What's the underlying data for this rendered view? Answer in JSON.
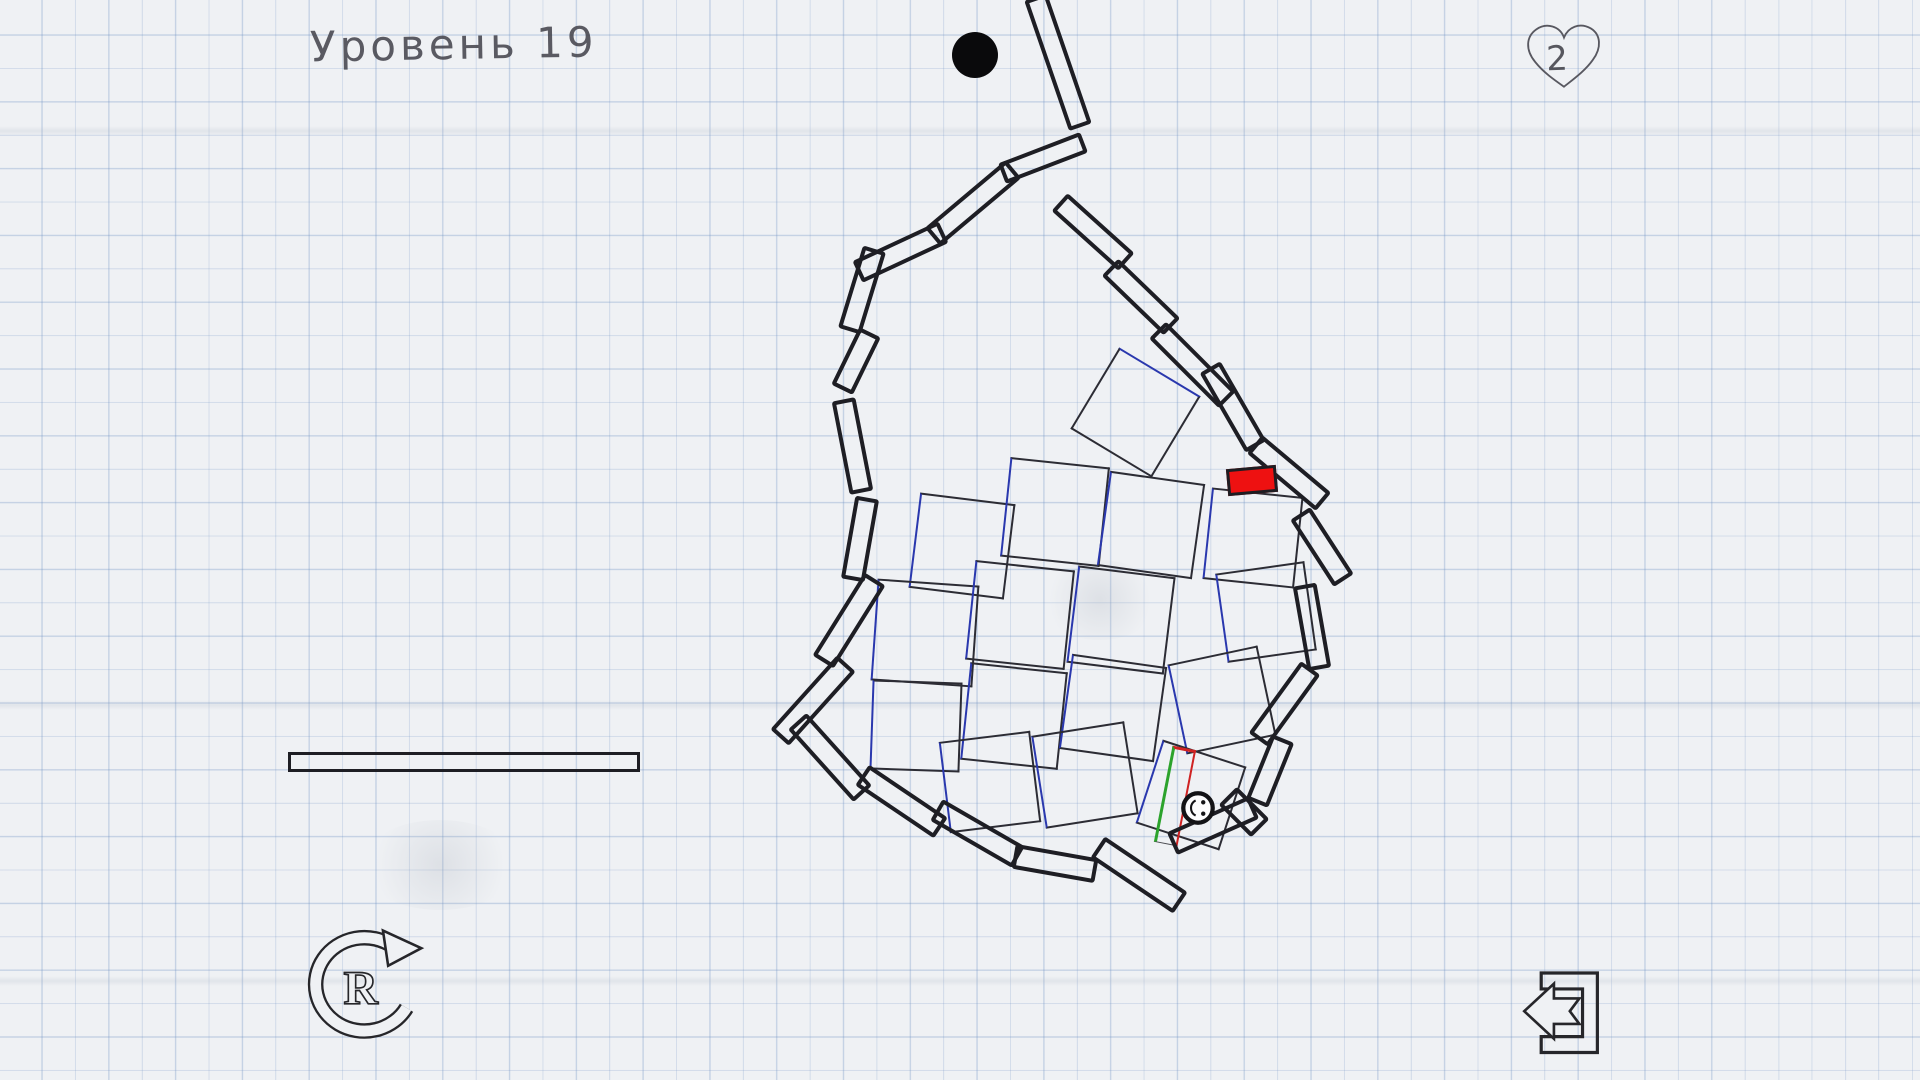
{
  "hud": {
    "level_label": "Уровень 19",
    "lives": "2"
  },
  "buttons": {
    "restart_letter": "R"
  },
  "colors": {
    "paper": "#eff1f4",
    "grid_line": "rgba(112,146,196,0.33)",
    "ink": "#1e1e24",
    "tile_ink": "#2c2c34",
    "blue_edge": "#2a38ae",
    "red_block": "#ee1111",
    "green_edge": "#2ca32c",
    "red_edge": "#cf2222",
    "text_ink": "#46464e"
  },
  "scene": {
    "ball": {
      "x": 975,
      "y": 55,
      "r": 23
    },
    "smiley": {
      "x": 1198,
      "y": 808,
      "r": 19
    },
    "red_block": {
      "x": 1252,
      "y": 480,
      "w": 50,
      "h": 27,
      "rot": -5
    },
    "bar": {
      "x": 464,
      "y": 762,
      "w": 352,
      "h": 20,
      "rot": 0
    },
    "goal_tile": {
      "x": 1175,
      "y": 796,
      "w": 24,
      "h": 98,
      "rot": 11
    },
    "diamond_tile": {
      "x": 1135,
      "y": 412,
      "s": 95,
      "rot": 31
    },
    "planks": [
      {
        "x": 1058,
        "y": 62,
        "len": 138,
        "w": 24,
        "rot": 71
      },
      {
        "x": 1043,
        "y": 158,
        "len": 88,
        "w": 22,
        "rot": -21
      },
      {
        "x": 973,
        "y": 203,
        "len": 106,
        "w": 24,
        "rot": -40
      },
      {
        "x": 900,
        "y": 252,
        "len": 95,
        "w": 24,
        "rot": -25
      },
      {
        "x": 862,
        "y": 290,
        "len": 86,
        "w": 24,
        "rot": -73
      },
      {
        "x": 856,
        "y": 361,
        "len": 64,
        "w": 24,
        "rot": -64
      },
      {
        "x": 852,
        "y": 446,
        "len": 95,
        "w": 24,
        "rot": 79
      },
      {
        "x": 860,
        "y": 539,
        "len": 84,
        "w": 24,
        "rot": 100
      },
      {
        "x": 849,
        "y": 620,
        "len": 98,
        "w": 25,
        "rot": 122
      },
      {
        "x": 813,
        "y": 700,
        "len": 100,
        "w": 25,
        "rot": 132
      },
      {
        "x": 830,
        "y": 757,
        "len": 98,
        "w": 25,
        "rot": 48
      },
      {
        "x": 901,
        "y": 801,
        "len": 95,
        "w": 25,
        "rot": 34
      },
      {
        "x": 977,
        "y": 833,
        "len": 95,
        "w": 25,
        "rot": 30
      },
      {
        "x": 1055,
        "y": 863,
        "len": 84,
        "w": 25,
        "rot": 10
      },
      {
        "x": 1139,
        "y": 875,
        "len": 100,
        "w": 26,
        "rot": 34
      },
      {
        "x": 1213,
        "y": 825,
        "len": 90,
        "w": 25,
        "rot": -24
      },
      {
        "x": 1244,
        "y": 812,
        "len": 46,
        "w": 26,
        "rot": 45
      },
      {
        "x": 1270,
        "y": 771,
        "len": 70,
        "w": 24,
        "rot": 112
      },
      {
        "x": 1284,
        "y": 704,
        "len": 89,
        "w": 24,
        "rot": 126
      },
      {
        "x": 1312,
        "y": 627,
        "len": 86,
        "w": 24,
        "rot": 80
      },
      {
        "x": 1322,
        "y": 547,
        "len": 80,
        "w": 24,
        "rot": 57
      },
      {
        "x": 1289,
        "y": 473,
        "len": 90,
        "w": 24,
        "rot": 40
      },
      {
        "x": 1233,
        "y": 407,
        "len": 92,
        "w": 24,
        "rot": 60
      },
      {
        "x": 1192,
        "y": 365,
        "len": 99,
        "w": 24,
        "rot": 45
      },
      {
        "x": 1141,
        "y": 297,
        "len": 86,
        "w": 24,
        "rot": 44
      },
      {
        "x": 1093,
        "y": 232,
        "len": 90,
        "w": 24,
        "rot": 42
      }
    ],
    "tiles": [
      {
        "x": 962,
        "y": 546,
        "s": 96,
        "rot": 7
      },
      {
        "x": 1055,
        "y": 512,
        "s": 100,
        "rot": 6
      },
      {
        "x": 1151,
        "y": 525,
        "s": 96,
        "rot": 8
      },
      {
        "x": 1253,
        "y": 538,
        "s": 92,
        "rot": 6
      },
      {
        "x": 925,
        "y": 633,
        "s": 102,
        "rot": 4
      },
      {
        "x": 1020,
        "y": 615,
        "s": 100,
        "rot": 6
      },
      {
        "x": 1121,
        "y": 620,
        "s": 98,
        "rot": 7
      },
      {
        "x": 1266,
        "y": 612,
        "s": 90,
        "rot": -8
      },
      {
        "x": 916,
        "y": 726,
        "s": 90,
        "rot": 2
      },
      {
        "x": 1014,
        "y": 716,
        "s": 98,
        "rot": 6
      },
      {
        "x": 1113,
        "y": 708,
        "s": 96,
        "rot": 8
      },
      {
        "x": 1222,
        "y": 700,
        "s": 92,
        "rot": -12
      },
      {
        "x": 990,
        "y": 782,
        "s": 92,
        "rot": -7
      },
      {
        "x": 1085,
        "y": 775,
        "s": 94,
        "rot": -9
      },
      {
        "x": 1191,
        "y": 795,
        "s": 88,
        "rot": 18
      }
    ]
  }
}
